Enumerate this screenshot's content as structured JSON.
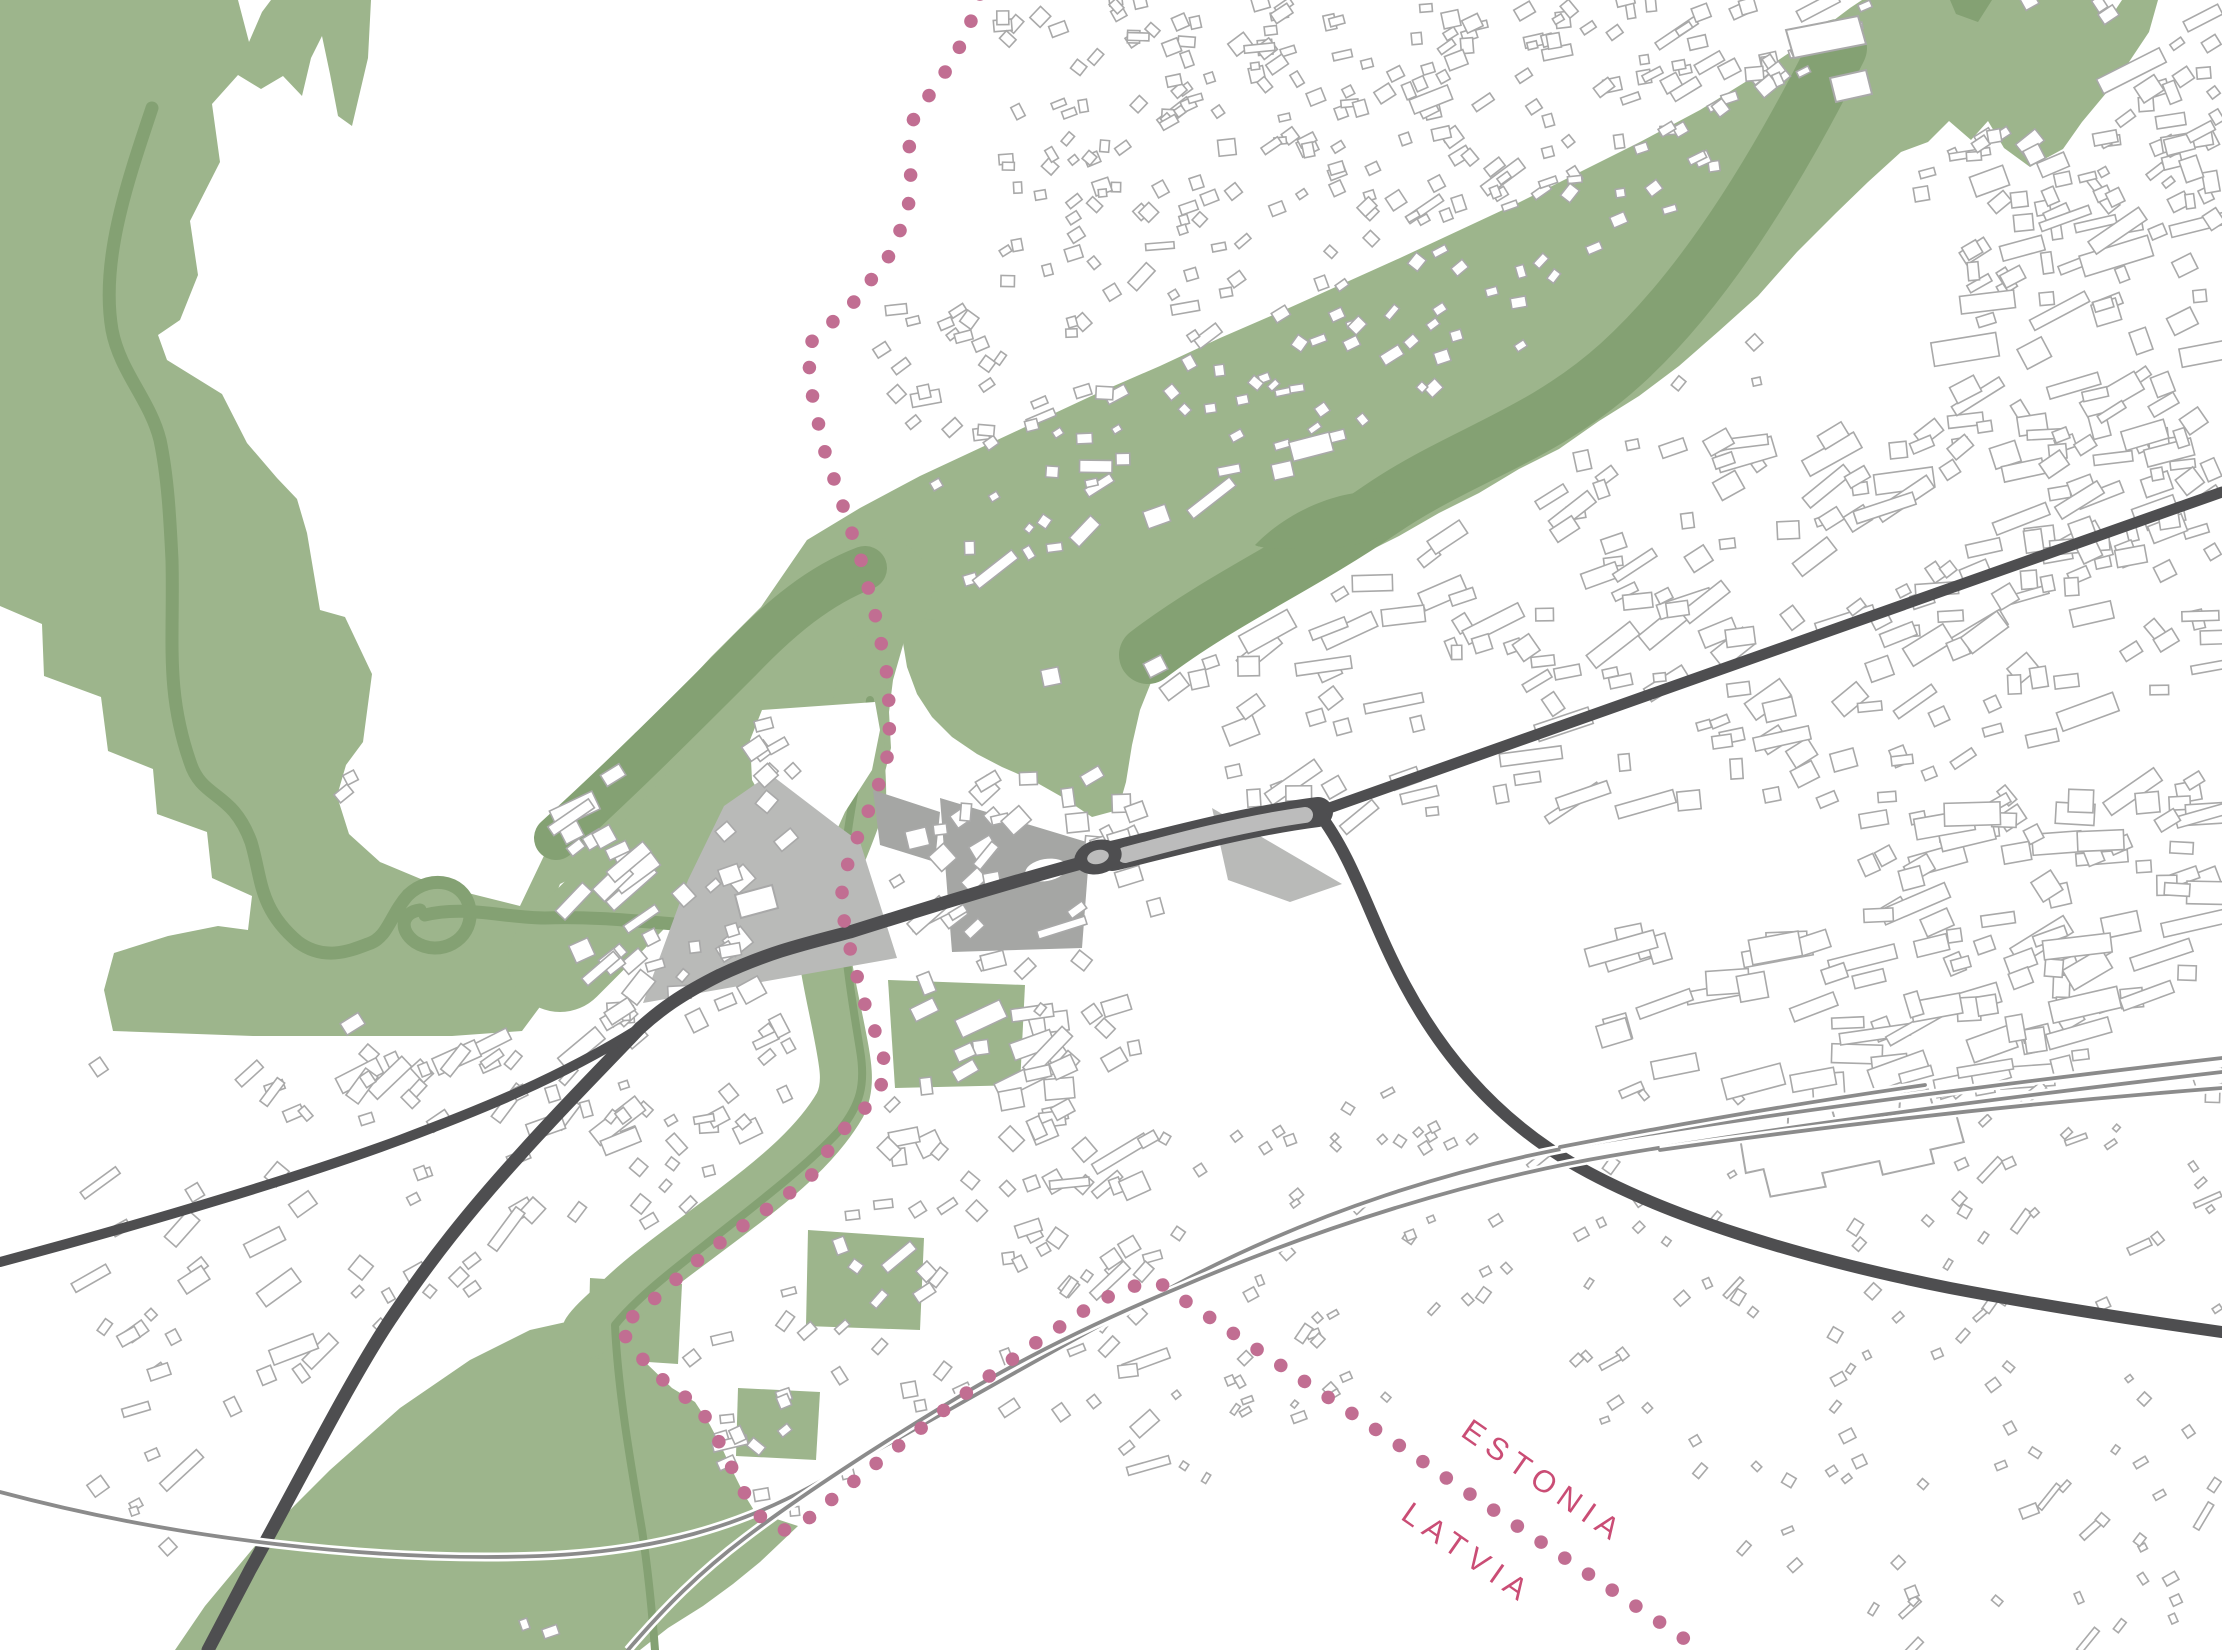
{
  "labels": {
    "estonia": "ESTONIA",
    "latvia": "LATVIA"
  },
  "colors": {
    "background": "#ffffff",
    "green_light": "#9db58c",
    "green_dark": "#84a173",
    "gray_light": "#b9bab8",
    "gray_medium": "#a5a6a4",
    "road_dark": "#4e4e50",
    "road_median": "#bcbcbc",
    "rail_gray": "#8b8b8b",
    "building_fill": "#ffffff",
    "building_outline": "#a9a9a9",
    "border_dot": "#c16e92",
    "label_pink": "#ca4d75"
  },
  "map": {
    "green_areas": [
      {
        "name": "northwest-forest",
        "d": "M0,0 L238,0 L249,42 L262,12 L271,0 L371,0 L368,58 L352,126 L338,116 L330,74 L322,36 L311,58 L302,96 L283,76 L261,89 L238,75 L212,104 L220,162 L190,221 L198,275 L180,320 L158,335 L167,360 L222,394 L247,443 L277,478 L297,499 L307,533 L320,610 L345,617 L372,674 L363,742 L346,765 L337,796 L349,834 L380,862 L428,882 L472,894 L520,906 L548,925 L545,1000 L522,1031 L452,1036 L253,1036 L113,1031 L104,990 L114,953 L168,936 L218,926 L248,930 L252,896 L212,878 L207,832 L157,814 L153,769 L108,751 L101,697 L44,676 L42,624 L0,606 Z"
      },
      {
        "name": "river-valley-junction",
        "d": "M520,906 L562,818 L604,780 L644,727 L671,700 L711,657 L761,607 L807,540 L852,557 L906,583 L903,645 L893,680 L889,712 L891,748 L880,792 L863,828 L847,866 L815,843 L780,820 L751,802 L749,748 L744,712 L716,740 L684,775 L654,808 L622,843 L592,868 L560,884 L536,944 Z"
      },
      {
        "name": "northeast-green-band",
        "d": "M807,540 L860,508 L920,476 L980,448 L1040,420 L1100,392 L1160,366 L1220,338 L1280,312 L1340,285 L1400,258 L1460,230 L1520,202 L1580,172 L1640,142 L1700,110 L1755,76 L1805,42 L1850,8 L1862,0 L2098,0 L2106,24 L2122,0 L2158,0 L2149,32 L2117,80 L2082,122 L2063,149 L2030,167 L2004,148 L1988,121 L1971,140 L1949,121 L1928,142 L1901,152 L1868,182 L1836,213 L1797,252 L1758,296 L1719,331 L1679,366 L1639,396 L1599,421 L1559,449 L1519,469 L1479,493 L1439,513 L1399,536 L1359,556 L1319,579 L1279,601 L1244,623 L1205,641 L1175,658 L1152,680 L1140,710 L1132,745 L1126,782 L1118,810 L1092,817 L1062,797 L1032,780 L1002,767 L977,754 L952,737 L932,717 L917,694 L907,667 L902,637 L907,602 L913,577 L888,566 L862,580 L838,600 L815,622 L790,648 L765,672 L742,696 Z"
      },
      {
        "name": "southwest-field",
        "d": "M618,1330 L645,1362 L672,1388 L695,1402 L710,1425 L722,1448 L733,1472 L744,1494 L755,1512 L798,1526 L760,1562 L733,1584 L703,1606 L668,1628 L640,1650 L175,1650 L205,1606 L260,1540 L330,1470 L400,1408 L470,1360 L530,1330 L575,1320 Z"
      },
      {
        "name": "riverside-patch-a",
        "d": "M888,980 L1025,985 L1020,1085 L895,1088 Z"
      },
      {
        "name": "riverside-patch-b",
        "d": "M808,1230 L924,1238 L920,1330 L806,1326 Z"
      },
      {
        "name": "riverside-patch-c",
        "d": "M590,1278 L682,1284 L678,1364 L588,1358 Z"
      },
      {
        "name": "riverside-patch-d",
        "d": "M738,1388 L820,1392 L816,1460 L736,1456 Z"
      },
      {
        "name": "riverside-patch-e",
        "d": "M905,588 L938,592 L935,620 L902,616 Z"
      }
    ],
    "green_corridor_strokes": [
      {
        "name": "valley-junction-fill",
        "d": "M560,960 C620,900 680,840 740,770 C790,710 830,640 880,590",
        "width": 104
      },
      {
        "name": "pedeli-corridor",
        "d": "M868,660 C850,720 862,770 860,800 C848,840 826,880 822,910 C820,945 830,985 838,1025 C846,1065 850,1085 840,1105 C818,1143 778,1177 738,1207 C693,1242 648,1272 618,1302 C600,1318 592,1326 588,1332",
        "width": 52
      }
    ],
    "green_dark_strokes": [
      {
        "name": "nw-river",
        "d": "M152,108 C128,180 100,260 112,330 C120,372 150,400 160,440 C168,478 170,520 172,560 C174,640 165,690 190,762 C202,800 232,790 251,842 C262,878 258,908 298,942 C325,962 352,950 368,944 C388,938 390,915 408,895 C432,872 468,882 470,912 C472,940 440,958 415,942 C398,930 402,912 420,910",
        "width": 13
      },
      {
        "name": "nw-river-band",
        "d": "M425,915 C465,905 505,918 545,918 C595,916 645,922 700,926 C725,928 745,918 762,906",
        "width": 13
      },
      {
        "name": "valley-dark-band",
        "d": "M556,838 C620,780 680,720 740,660 C780,618 820,585 865,568",
        "width": 44
      },
      {
        "name": "ne-dark-band",
        "d": "M1148,655 C1220,600 1300,565 1380,510 C1460,455 1540,437 1620,365 C1700,293 1772,180 1838,48",
        "width": 58
      },
      {
        "name": "corridor-stream",
        "d": "M870,700 C862,760 846,820 843,880 C841,940 852,1000 860,1050 C866,1085 860,1105 840,1130 C805,1168 755,1205 705,1245 C668,1274 635,1300 615,1325 C618,1390 630,1460 642,1530 C648,1570 652,1610 655,1650",
        "width": 8
      }
    ],
    "green_dark_fills": [
      {
        "name": "ne-oxbow-loop",
        "d": "M1255,545 C1300,498 1378,478 1408,502 C1430,522 1370,548 1318,549 C1285,549 1262,549 1255,545 Z"
      },
      {
        "name": "ne-corner-dark",
        "d": "M1950,0 L1992,0 L1978,22 L1956,14 Z"
      }
    ],
    "white_cutouts": [
      {
        "name": "town-tip-wedge",
        "d": "M762,710 L875,702 L880,730 L872,770 L845,812 L830,845 L800,838 L770,812 L752,780 L750,740 Z"
      }
    ],
    "gray_areas": [
      {
        "name": "central-gray-wedge",
        "tone": "gray_light",
        "d": "M770,774 L838,826 L860,842 L897,958 L643,1003 L688,880 L724,806 Z"
      },
      {
        "name": "station-square-plaza",
        "tone": "gray_medium",
        "d": "M940,798 L1090,843 L1082,948 L952,952 Z"
      },
      {
        "name": "northeast-plaza",
        "tone": "gray_light",
        "d": "M1212,808 L1342,884 L1290,902 L1228,880 Z"
      },
      {
        "name": "east-of-border-plaza",
        "tone": "gray_medium",
        "d": "M873,790 L940,812 L935,862 L880,845 Z"
      }
    ],
    "plaza_pond": {
      "cx": 1046,
      "cy": 870,
      "rx": 21,
      "ry": 11,
      "rot": -10
    },
    "landmarks": [
      {
        "name": "railway-station",
        "d": "M1742,1128 L1790,1124 L1792,1110 L1836,1106 L1840,1128 L1902,1122 L1906,1100 L1934,1098 L1938,1120 L1958,1118 L1964,1154 L1930,1158 L1932,1172 L1880,1178 L1878,1164 L1820,1170 L1822,1184 L1766,1188 L1762,1160 L1744,1162 Z",
        "rot": [
          -6,
          1850,
          1150
        ]
      },
      {
        "name": "green-slab-building-1",
        "d": "M1786,30 L1858,16 L1866,44 L1794,58 Z",
        "rot": [
          0,
          0,
          0
        ]
      },
      {
        "name": "green-slab-building-2",
        "d": "M1830,78 L1866,70 L1872,94 L1836,102 Z",
        "rot": [
          0,
          0,
          0
        ]
      },
      {
        "name": "wedge-building",
        "d": "M735,895 L772,885 L778,908 L741,918 Z",
        "rot": [
          0,
          0,
          0
        ]
      }
    ],
    "roads": [
      {
        "name": "highway-northeast",
        "d": "M2222,492 L1318,812",
        "width": 11
      },
      {
        "name": "boulevard-casing",
        "d": "M1318,812 C1240,822 1160,845 1112,856",
        "width": 30,
        "tone": "road_dark"
      },
      {
        "name": "road-west-of-roundabout",
        "d": "M1085,862 C1000,885 920,910 850,932 C800,945 770,952 720,975 C680,995 660,1010 640,1028",
        "width": 13
      },
      {
        "name": "road-southwest",
        "d": "M640,1028 C600,1070 560,1110 520,1155 C470,1210 430,1260 390,1320 C350,1380 300,1480 250,1570 L208,1650",
        "width": 13
      },
      {
        "name": "road-west",
        "d": "M640,1028 C560,1078 480,1110 400,1140 C300,1177 150,1222 0,1262",
        "width": 10
      },
      {
        "name": "road-southeast",
        "d": "M1318,812 C1355,860 1370,920 1405,985 C1445,1060 1500,1120 1570,1162 C1660,1215 1800,1258 1950,1288 C2050,1307 2150,1322 2222,1332",
        "width": 12
      }
    ],
    "boulevard_median": {
      "d": "M1305,815 C1240,824 1170,843 1125,855",
      "width": 16
    },
    "rails": [
      {
        "name": "rail-main",
        "d": "M0,1492 C180,1540 380,1562 540,1556 C660,1551 740,1525 810,1487 C920,1428 1060,1345 1170,1288 C1310,1213 1460,1165 1600,1142 C1800,1109 2050,1078 2222,1058"
      },
      {
        "name": "rail-second",
        "d": "M628,1650 C665,1607 700,1572 745,1538 C800,1496 880,1444 960,1396 C1040,1348 1120,1312 1178,1288 C1320,1227 1470,1180 1610,1156 C1810,1122 2050,1092 2222,1072"
      },
      {
        "name": "rail-siding-stub",
        "d": "M1560,1147 C1700,1120 1820,1100 1925,1085"
      },
      {
        "name": "rail-siding-long",
        "d": "M1660,1150 C1800,1130 2000,1105 2222,1088"
      }
    ],
    "roundabout": {
      "cx": 1098,
      "cy": 857,
      "rx": 24,
      "ry": 17,
      "irx": 11,
      "iry": 7,
      "rot": -14
    },
    "border": {
      "d": "M980,-6 L968,30 L952,62 L930,94 L908,128 L911,170 L908,212 L889,256 L856,300 L807,346 L813,400 L825,452 L843,506 L861,560 L875,614 L886,666 L890,716 L888,754 L877,790 L863,824 L849,858 L842,892 L844,920 L850,948 L857,976 L864,1002 L873,1026 L882,1050 L887,1076 L867,1106 L840,1133 L809,1179 L770,1207 L731,1234 L692,1265 L653,1300 L619,1328 L645,1362 L673,1390 L697,1404 L711,1426 L723,1450 L734,1472 L745,1494 L756,1512 L770,1526 L784,1530 L797,1527 L809,1518 L836,1496 L864,1473 L892,1451 L920,1429 L948,1407 L977,1385 L1007,1363 L1037,1342 L1067,1322 L1097,1302 L1127,1288 L1147,1283 L1163,1285 L1172,1292 L1212,1319 L1252,1346 L1292,1373 L1332,1400 L1372,1427 L1412,1454 L1452,1482 L1492,1509 L1532,1536 L1572,1563 L1612,1590 L1652,1617 L1692,1644 L1706,1654",
      "dot_width": 13.5,
      "dot_gap": 28.5
    },
    "label_positions": [
      {
        "key": "estonia",
        "x": 1538,
        "y": 1490,
        "rot": 35
      },
      {
        "key": "latvia",
        "x": 1462,
        "y": 1562,
        "rot": 35
      }
    ],
    "districts": [
      [
        990,
        0,
        200,
        300,
        60,
        8,
        18,
        -25,
        30,
        0.1,
        11
      ],
      [
        880,
        300,
        310,
        260,
        50,
        8,
        18,
        -25,
        30,
        0.1,
        12
      ],
      [
        1160,
        0,
        1062,
        210,
        240,
        8,
        20,
        -22,
        18,
        0.1,
        13
      ],
      [
        1180,
        190,
        580,
        280,
        110,
        8,
        16,
        -30,
        25,
        0.05,
        14
      ],
      [
        1960,
        30,
        262,
        540,
        110,
        10,
        30,
        -20,
        15,
        0.3,
        15
      ],
      [
        1150,
        430,
        1072,
        390,
        240,
        10,
        26,
        -20,
        20,
        0.35,
        16
      ],
      [
        1850,
        800,
        372,
        300,
        70,
        12,
        30,
        -15,
        20,
        0.4,
        17
      ],
      [
        890,
        560,
        280,
        290,
        70,
        10,
        24,
        -20,
        25,
        0.15,
        18
      ],
      [
        755,
        705,
        115,
        140,
        14,
        10,
        22,
        -30,
        20,
        0.1,
        19
      ],
      [
        615,
        830,
        545,
        360,
        150,
        9,
        26,
        -28,
        25,
        0.2,
        20
      ],
      [
        340,
        770,
        300,
        310,
        95,
        10,
        26,
        -35,
        15,
        0.45,
        21
      ],
      [
        90,
        1050,
        540,
        520,
        120,
        8,
        22,
        -35,
        20,
        0.25,
        22
      ],
      [
        640,
        1180,
        520,
        360,
        100,
        8,
        20,
        -30,
        25,
        0.1,
        23
      ],
      [
        1160,
        1090,
        1062,
        560,
        210,
        6,
        14,
        -40,
        20,
        0.1,
        24
      ],
      [
        1600,
        930,
        500,
        170,
        45,
        12,
        34,
        -12,
        10,
        0.5,
        25
      ],
      [
        380,
        1560,
        700,
        90,
        30,
        8,
        16,
        -30,
        20,
        0.1,
        26
      ]
    ],
    "exclusions": [
      [
        850,
        950,
        70
      ],
      [
        858,
        1050,
        62
      ],
      [
        815,
        1150,
        62
      ],
      [
        745,
        1225,
        60
      ],
      [
        675,
        1290,
        55
      ],
      [
        625,
        1330,
        50
      ],
      [
        340,
        1540,
        170
      ],
      [
        500,
        1460,
        130
      ],
      [
        620,
        1520,
        120
      ],
      [
        250,
        1628,
        90
      ],
      [
        680,
        1610,
        90
      ],
      [
        560,
        1380,
        80
      ],
      [
        870,
        700,
        70
      ],
      [
        900,
        620,
        65
      ],
      [
        960,
        650,
        70
      ],
      [
        1030,
        620,
        60
      ],
      [
        1100,
        640,
        60
      ],
      [
        1120,
        720,
        55
      ],
      [
        1000,
        720,
        60
      ],
      [
        930,
        760,
        55
      ],
      [
        860,
        800,
        55
      ],
      [
        840,
        870,
        55
      ],
      [
        1200,
        590,
        70
      ],
      [
        1280,
        545,
        70
      ],
      [
        1360,
        500,
        70
      ],
      [
        1440,
        460,
        70
      ],
      [
        1520,
        420,
        72
      ],
      [
        1600,
        360,
        75
      ],
      [
        1680,
        300,
        78
      ],
      [
        1760,
        235,
        80
      ],
      [
        1840,
        155,
        85
      ],
      [
        1915,
        80,
        80
      ],
      [
        1990,
        60,
        70
      ],
      [
        2060,
        80,
        60
      ],
      [
        420,
        980,
        80
      ],
      [
        330,
        950,
        70
      ],
      [
        520,
        960,
        60
      ],
      [
        560,
        1000,
        50
      ],
      [
        575,
        1340,
        60
      ],
      [
        500,
        800,
        70
      ],
      [
        450,
        750,
        70
      ],
      [
        520,
        870,
        50
      ],
      [
        420,
        830,
        80
      ],
      [
        380,
        900,
        60
      ],
      [
        480,
        880,
        60
      ],
      [
        820,
        400,
        60
      ],
      [
        850,
        480,
        55
      ],
      [
        880,
        560,
        50
      ],
      [
        888,
        640,
        50
      ],
      [
        1500,
        1540,
        130
      ],
      [
        1620,
        1600,
        110
      ],
      [
        1380,
        1500,
        90
      ],
      [
        1300,
        1560,
        120
      ],
      [
        1450,
        1640,
        100
      ],
      [
        1000,
        1560,
        140
      ],
      [
        850,
        1600,
        100
      ],
      [
        1150,
        1620,
        110
      ],
      [
        1046,
        870,
        45
      ],
      [
        762,
        905,
        30
      ]
    ]
  }
}
